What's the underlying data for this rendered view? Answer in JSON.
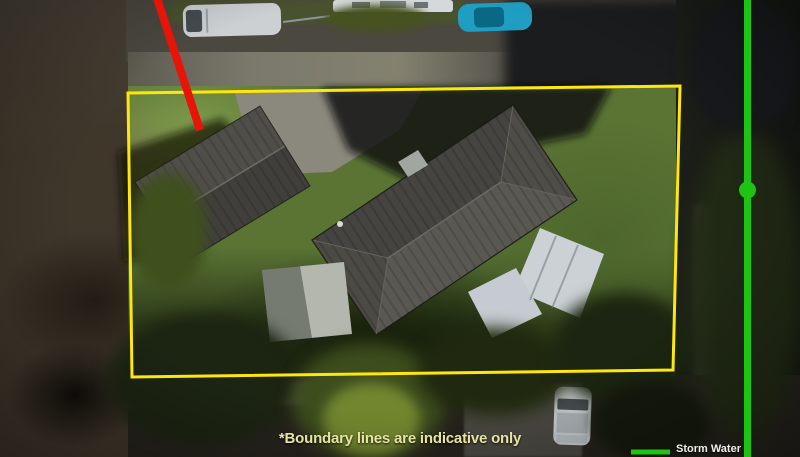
{
  "overlay": {
    "caption": "*Boundary lines are indicative only",
    "legend": {
      "storm_water": "Storm Water"
    }
  },
  "colors": {
    "boundary-yellow": "#ffe70c",
    "marker-red": "#e81408",
    "storm-water-green": "#1ec413",
    "caption-text": "#e6e3a3",
    "legend-text": "#f0f0ec"
  }
}
